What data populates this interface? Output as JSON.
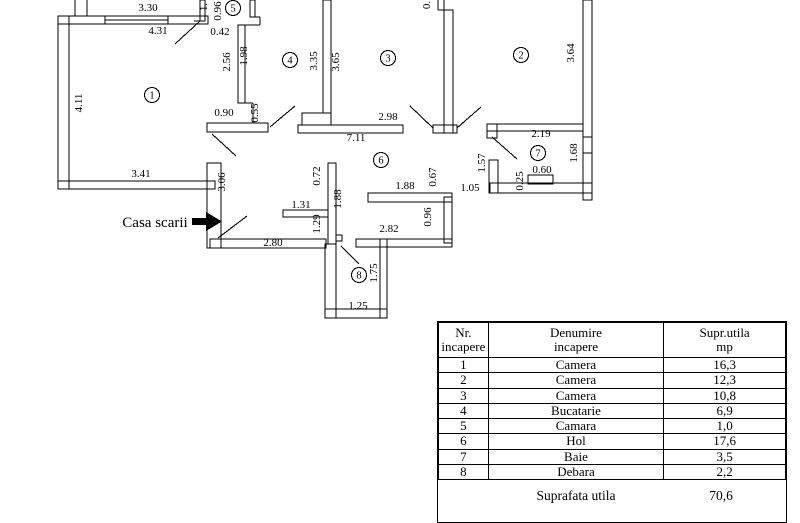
{
  "floorplan": {
    "stairwell_label": "Casa scarii",
    "dim_labels": [
      {
        "t": "3.30",
        "x": 148,
        "y": 11,
        "v": false
      },
      {
        "t": "4.31",
        "x": 158,
        "y": 34,
        "v": false
      },
      {
        "t": "1.",
        "x": 207,
        "y": 7,
        "v": true
      },
      {
        "t": "0.96",
        "x": 221,
        "y": 11,
        "v": true
      },
      {
        "t": "0.42",
        "x": 220,
        "y": 35,
        "v": false
      },
      {
        "t": "2.56",
        "x": 230,
        "y": 62,
        "v": true
      },
      {
        "t": "1.98",
        "x": 247,
        "y": 56,
        "v": true
      },
      {
        "t": "3.35",
        "x": 317,
        "y": 61,
        "v": true
      },
      {
        "t": "3.65",
        "x": 339,
        "y": 62,
        "v": true
      },
      {
        "t": "0.",
        "x": 430,
        "y": 5,
        "v": true
      },
      {
        "t": "3.64",
        "x": 574,
        "y": 53,
        "v": true
      },
      {
        "t": "4.11",
        "x": 82,
        "y": 103,
        "v": true
      },
      {
        "t": "0.90",
        "x": 224,
        "y": 116,
        "v": false
      },
      {
        "t": "0.55",
        "x": 258,
        "y": 113,
        "v": true
      },
      {
        "t": "2.98",
        "x": 388,
        "y": 120,
        "v": false
      },
      {
        "t": "7.11",
        "x": 356,
        "y": 141,
        "v": false
      },
      {
        "t": "2.19",
        "x": 541,
        "y": 137,
        "v": false
      },
      {
        "t": "1.68",
        "x": 577,
        "y": 153,
        "v": true
      },
      {
        "t": "3.41",
        "x": 141,
        "y": 177,
        "v": false
      },
      {
        "t": "3.06",
        "x": 225,
        "y": 182,
        "v": true
      },
      {
        "t": "1.57",
        "x": 485,
        "y": 163,
        "v": true
      },
      {
        "t": "0.72",
        "x": 320,
        "y": 176,
        "v": true
      },
      {
        "t": "1.88",
        "x": 341,
        "y": 199,
        "v": true
      },
      {
        "t": "1.88",
        "x": 405,
        "y": 189,
        "v": false
      },
      {
        "t": "0.67",
        "x": 436,
        "y": 177,
        "v": true
      },
      {
        "t": "1.05",
        "x": 470,
        "y": 191,
        "v": false
      },
      {
        "t": "0.25",
        "x": 523,
        "y": 181,
        "v": true
      },
      {
        "t": "0.60",
        "x": 542,
        "y": 173,
        "v": false
      },
      {
        "t": "1.31",
        "x": 301,
        "y": 208,
        "v": false
      },
      {
        "t": "1.29",
        "x": 320,
        "y": 224,
        "v": true
      },
      {
        "t": "0.96",
        "x": 431,
        "y": 217,
        "v": true
      },
      {
        "t": "2.82",
        "x": 389,
        "y": 232,
        "v": false
      },
      {
        "t": "2.80",
        "x": 273,
        "y": 246,
        "v": false
      },
      {
        "t": "1.75",
        "x": 377,
        "y": 273,
        "v": true
      },
      {
        "t": "1.25",
        "x": 358,
        "y": 309,
        "v": false
      }
    ],
    "room_markers": [
      {
        "n": "1",
        "x": 152,
        "y": 95
      },
      {
        "n": "2",
        "x": 521,
        "y": 55
      },
      {
        "n": "3",
        "x": 388,
        "y": 58
      },
      {
        "n": "4",
        "x": 290,
        "y": 60
      },
      {
        "n": "5",
        "x": 233,
        "y": 8
      },
      {
        "n": "6",
        "x": 381,
        "y": 160
      },
      {
        "n": "7",
        "x": 538,
        "y": 153
      },
      {
        "n": "8",
        "x": 359,
        "y": 275
      }
    ]
  },
  "table": {
    "headers": [
      {
        "l1": "Nr.",
        "l2": "incapere"
      },
      {
        "l1": "Denumire",
        "l2": "incapere"
      },
      {
        "l1": "Supr.utila",
        "l2": "mp"
      }
    ],
    "rows": [
      [
        "1",
        "Camera",
        "16,3"
      ],
      [
        "2",
        "Camera",
        "12,3"
      ],
      [
        "3",
        "Camera",
        "10,8"
      ],
      [
        "4",
        "Bucatarie",
        "6,9"
      ],
      [
        "5",
        "Camara",
        "1,0"
      ],
      [
        "6",
        "Hol",
        "17,6"
      ],
      [
        "7",
        "Baie",
        "3,5"
      ],
      [
        "8",
        "Debara",
        "2,2"
      ]
    ],
    "footer": {
      "label": "Suprafata utila",
      "value": "70,6"
    }
  }
}
